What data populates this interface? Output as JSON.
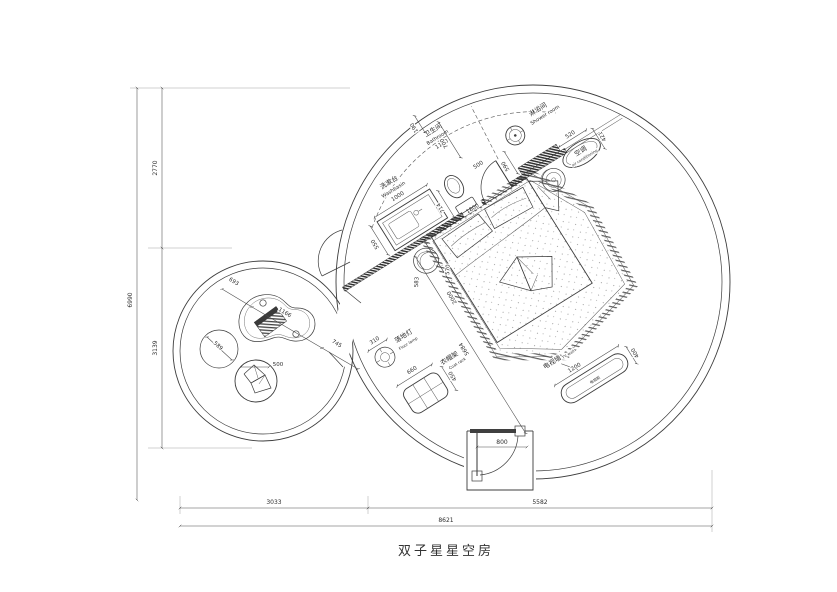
{
  "title": "双子星星空房",
  "dims": {
    "overall_height": "6990",
    "upper_height": "2770",
    "lower_height": "3139",
    "left_width": "3033",
    "right_width": "5582",
    "overall_width": "8621",
    "washbasin_length": "1000",
    "washbasin_depth": "550",
    "basin_toilet_gap": "714",
    "bathroom_width": "1100",
    "wall_top": "190",
    "bath_depth": "700",
    "bath_door": "500",
    "shower_pass": "590",
    "bed_width": "1800",
    "bed_length": "2000",
    "room_diagonal": "5684",
    "stool_a": "583",
    "stool_b": "570",
    "ac_width": "520",
    "ac_depth": "421",
    "tv_length": "1200",
    "tv_depth": "400",
    "entry_door": "800",
    "lamp_offset": "310",
    "rack_width": "660",
    "rack_depth": "450",
    "lounge_seg_a": "693",
    "lounge_table": "1166",
    "lounge_seg_b": "745",
    "pouf": "589",
    "beanbag": "500"
  },
  "labels": {
    "washbasin_cn": "洗漱台",
    "washbasin_en": "Washbasin",
    "bathroom_cn": "卫生间",
    "bathroom_en": "Bathroom",
    "shower_cn": "淋浴间",
    "shower_en": "Shower room",
    "ac_cn": "空调",
    "ac_en": "air conditioning",
    "tv_wall_cn": "电视墙",
    "tv_wall_en": "TV wall",
    "tv_cabinet_cn": "电视柜",
    "lamp_cn": "落地灯",
    "lamp_en": "Floor lamp",
    "rack_cn": "衣帽架",
    "rack_en": "Coat rack"
  }
}
